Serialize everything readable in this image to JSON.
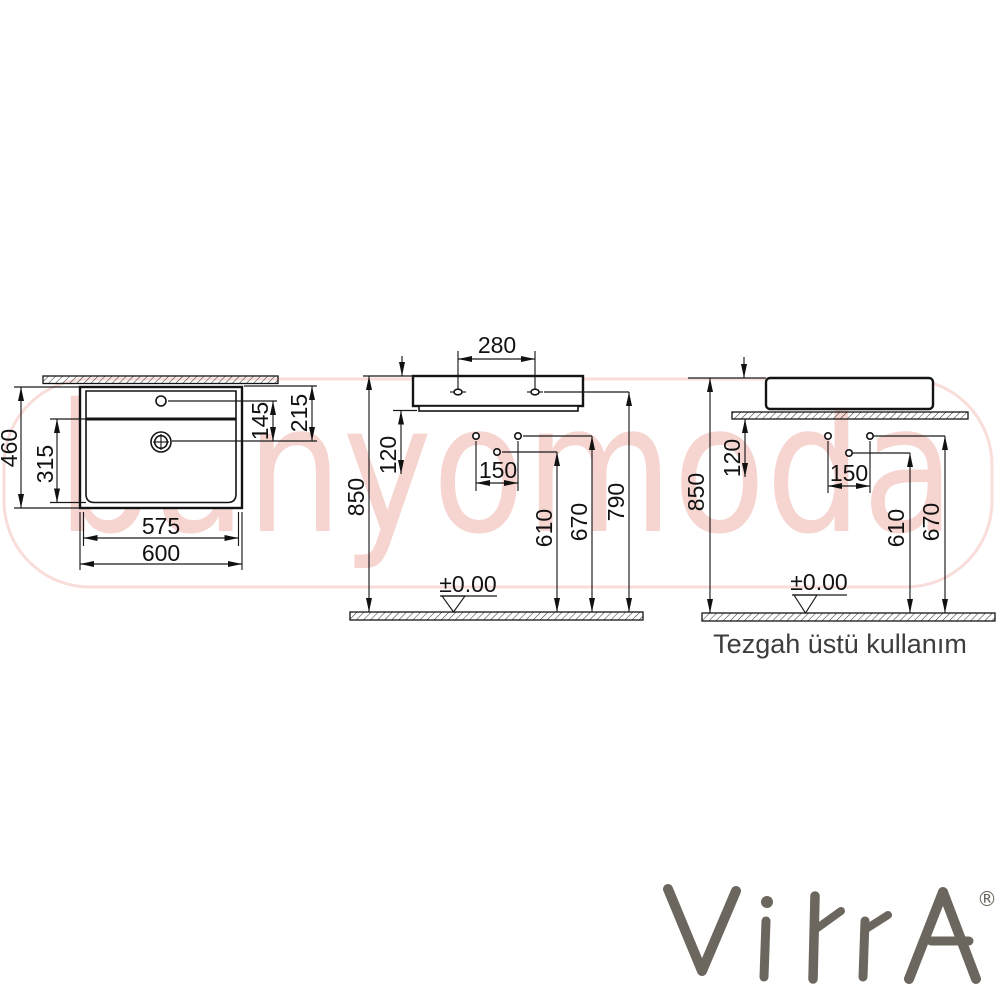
{
  "watermark": {
    "text": "banyomoda",
    "color": "#f6d4d0"
  },
  "caption": {
    "text": "Tezgah üstü kullanım"
  },
  "brand": {
    "name": "VitrA",
    "registered": "®",
    "color": "#6b675e"
  },
  "views": {
    "top": {
      "overall_depth": "460",
      "basin_depth": "315",
      "tap_to_drain": "145",
      "rim_to_drain": "215",
      "inner_width": "575",
      "overall_width": "600"
    },
    "front": {
      "tap_hole_spacing": "280",
      "under_rim": "120",
      "fixing_hole_spacing": "150",
      "rim_height": "850",
      "drain_line_height": "610",
      "fixing_holes_height": "670",
      "tap_line_height": "790",
      "floor_level": "±0.00"
    },
    "side": {
      "under_counter": "120",
      "fixing_hole_spacing": "150",
      "rim_height": "850",
      "drain_line_height": "610",
      "fixing_holes_height": "670",
      "floor_level": "±0.00"
    }
  }
}
